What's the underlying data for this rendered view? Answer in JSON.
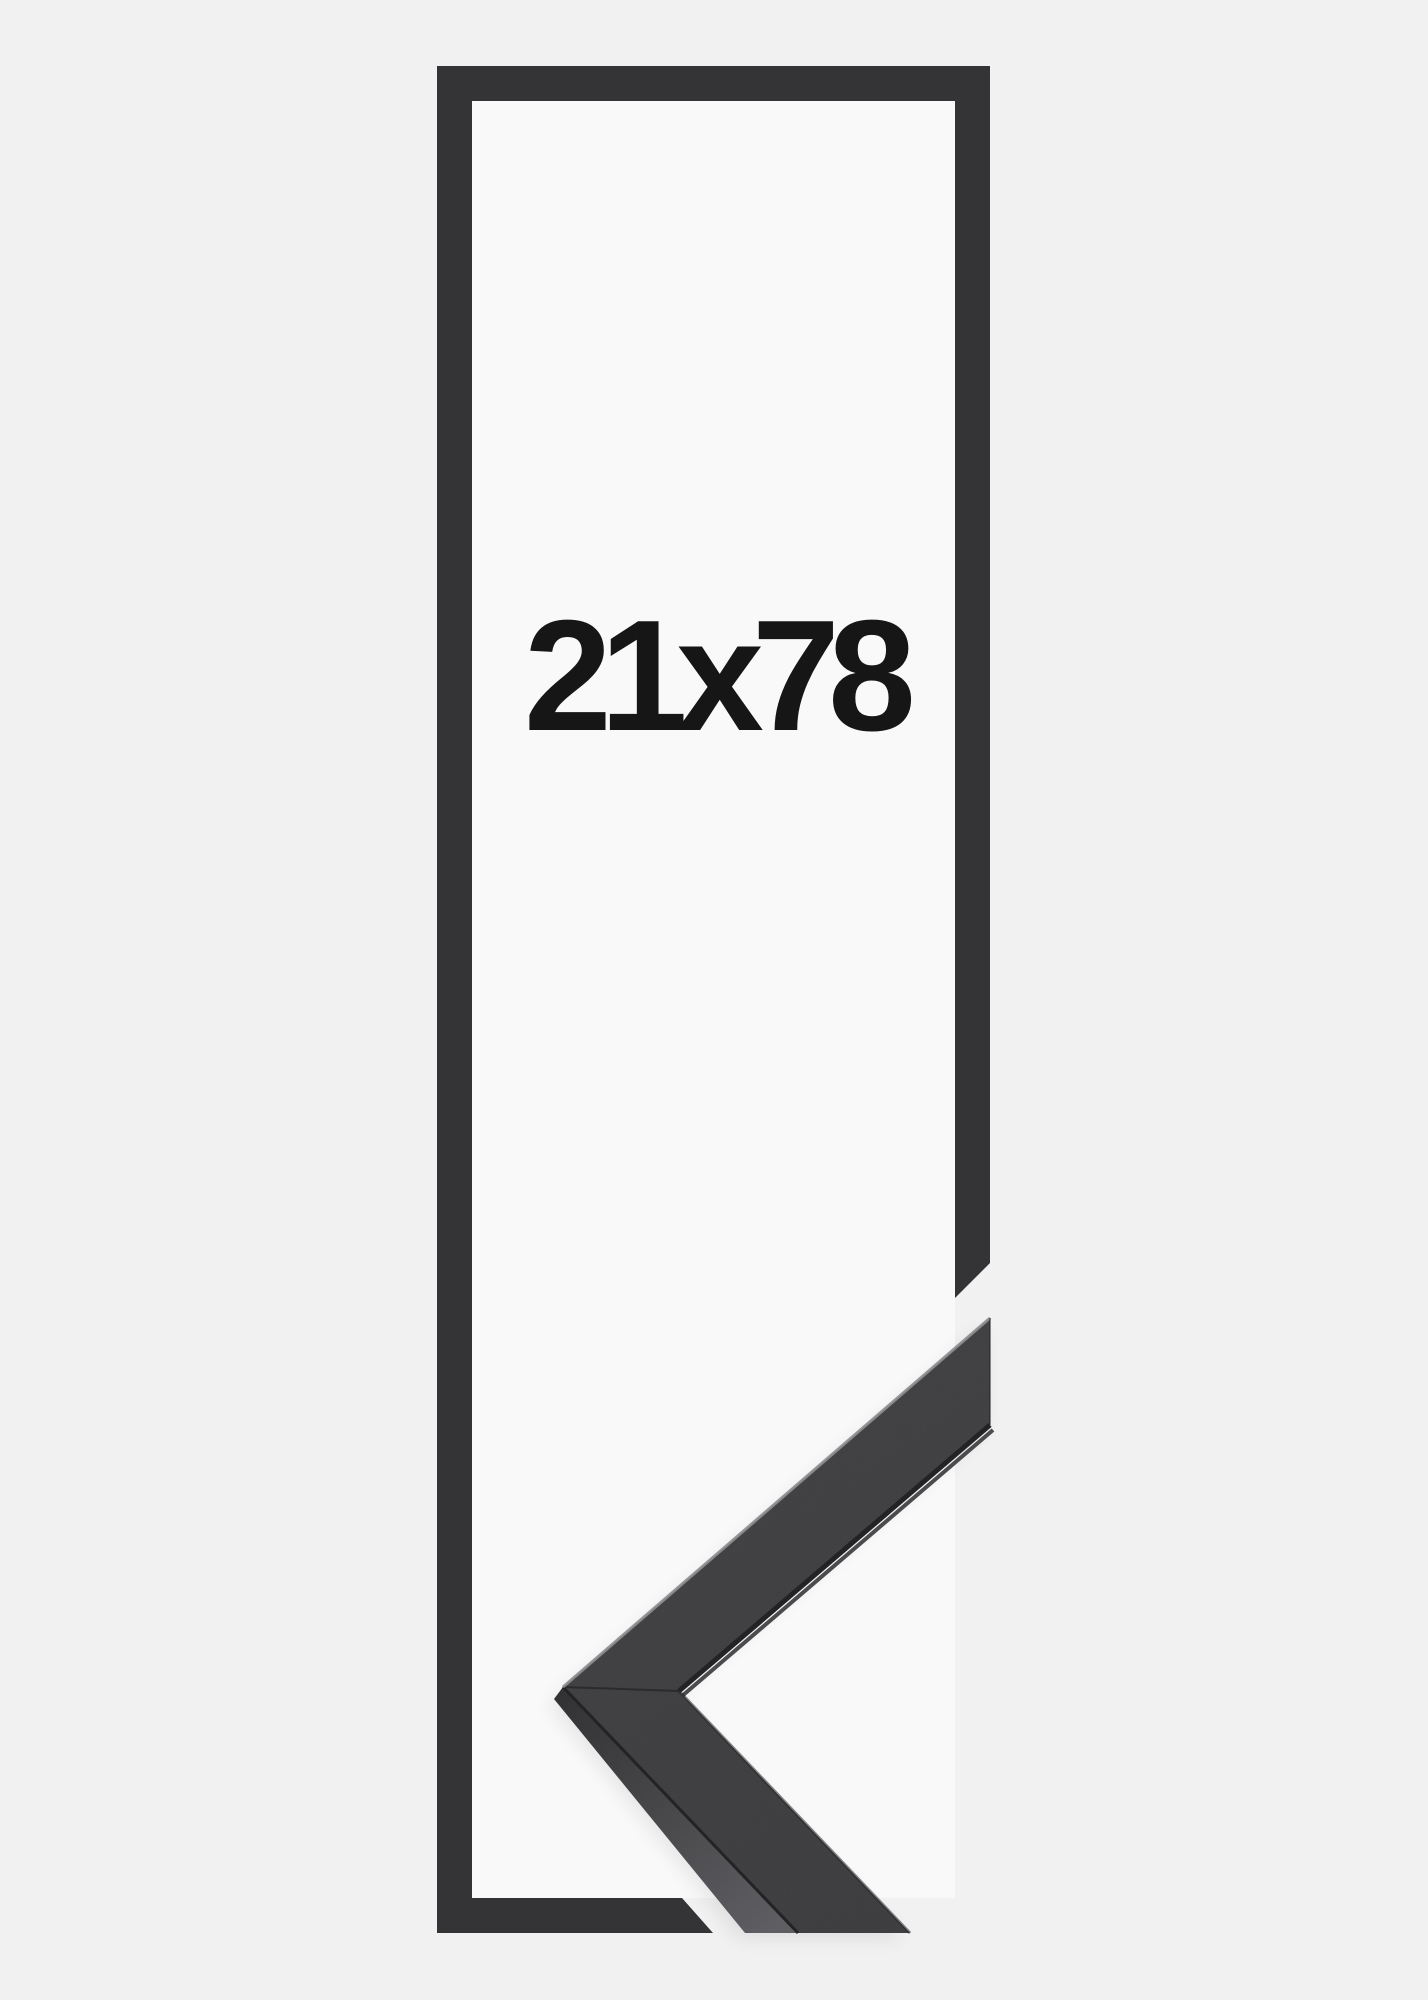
{
  "image": {
    "label": "21x78",
    "colors": {
      "background": "#f1f1f2",
      "inner_background": "#f9f9fa",
      "outline": "#343437",
      "face": "#3b3b3d",
      "side_dark": "#2c2c2e",
      "side_light": "#5a5a5e",
      "edge_dark": "#232325",
      "lip": "#4b4b4e",
      "highlight": "#8e8e91",
      "seam": "#29292b",
      "label_text": "#161616"
    }
  }
}
